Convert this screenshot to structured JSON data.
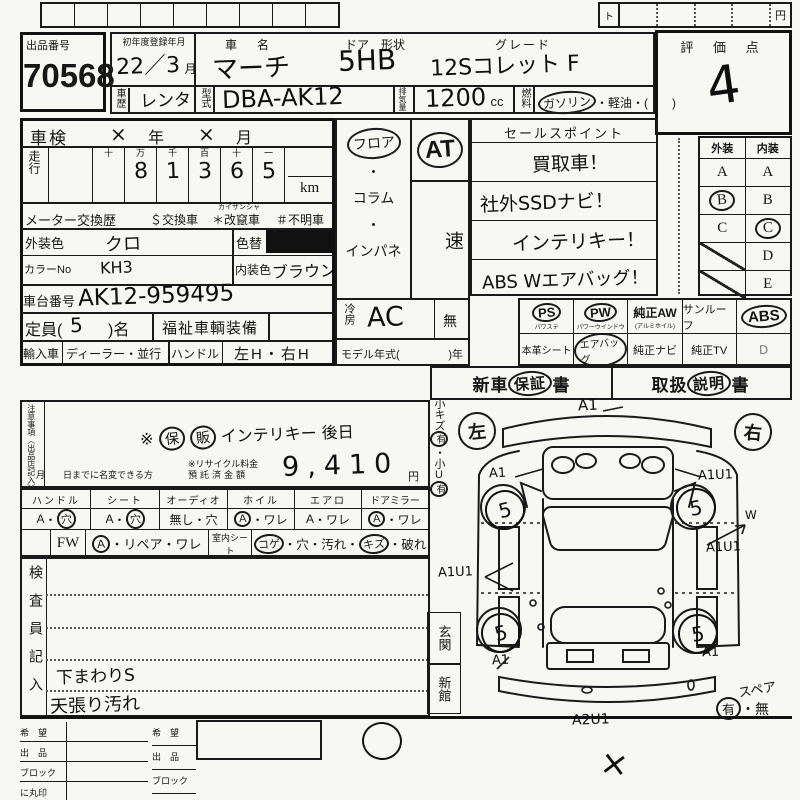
{
  "top": {
    "to": "ト",
    "yen": "円"
  },
  "header": {
    "auction_no_label": "出品番号",
    "auction_no": "70568",
    "first_reg_label": "初年度登録年月",
    "first_reg": "22／3",
    "first_reg_unit": "月",
    "history_label": "車歴",
    "history": "レンタ",
    "car_name_label": "車　名",
    "car_name": "マーチ",
    "door_label": "ドア　形状",
    "door": "5HB",
    "grade_label": "グレード",
    "grade": "12Sコレット F",
    "model_label": "型式",
    "model": "DBA-AK12",
    "disp_label": "排気量",
    "disp": "1200",
    "disp_unit": "cc",
    "fuel_label": "燃料",
    "fuel_gas": "ガソリン",
    "fuel_rest": "・軽油・(　　)",
    "score_label": "評 価 点",
    "score": "4"
  },
  "left": {
    "shaken_label": "車検",
    "x1": "×",
    "year": "年",
    "x2": "×",
    "month": "月",
    "mileage_label": "走行",
    "digit_headers": [
      "十",
      "万",
      "千",
      "百",
      "十",
      "一"
    ],
    "digits": [
      "",
      "8",
      "1",
      "3",
      "6",
      "5"
    ],
    "km": "km",
    "meter_label": "メーター交換歴",
    "meter1": "＄交換車",
    "meter2": "＊改竄車",
    "meter2_ruby": "カイザンシャ",
    "meter3": "＃不明車",
    "ext_color_label": "外装色",
    "ext_color": "クロ",
    "color_change_label": "色替",
    "color_no_label": "カラーNo",
    "color_no": "KH3",
    "int_color_label": "内装色",
    "int_color": "ブラウン",
    "chassis_label": "車台番号",
    "chassis": "AK12-959495",
    "cap_pre": "定員(",
    "cap": "5",
    "cap_post": ")名",
    "welfare": "福祉車輌装備",
    "import_label": "輸入車",
    "import_opts": "ディーラー・並行",
    "handle_label": "ハンドル",
    "handle_opts": "左H・右H"
  },
  "middle": {
    "floor": "フロア",
    "dot": "・",
    "column": "コラム",
    "panel": "インパネ",
    "at": "AT",
    "speed": "速",
    "ac_label": "冷房",
    "ac": "AC",
    "none": "無",
    "my_pre": "モデル年式(",
    "my_post": ")年"
  },
  "sales": {
    "title": "セールスポイント",
    "lines": [
      "買取車！",
      "社外SSDナビ！",
      "インテリキー！",
      "ABS Wエアバッグ！"
    ]
  },
  "grades": {
    "ext": "外装",
    "int": "内装",
    "rows": [
      {
        "e": "A",
        "i": "A"
      },
      {
        "e": "B",
        "i": "B"
      },
      {
        "e": "C",
        "i": "C"
      },
      {
        "e": "",
        "i": "D"
      },
      {
        "e": "",
        "i": "E"
      }
    ]
  },
  "equip": {
    "r1": [
      {
        "n": "PS",
        "s": "パワステ"
      },
      {
        "n": "PW",
        "s": "パワーウインドウ"
      },
      {
        "n": "純正AW",
        "s": "(アルミホイル)"
      },
      {
        "n": "サンルーフ",
        "s": ""
      },
      {
        "n": "ABS",
        "s": ""
      }
    ],
    "r2": [
      {
        "n": "本革シート"
      },
      {
        "n": "エアバッグ"
      },
      {
        "n": "純正ナビ"
      },
      {
        "n": "純正TV"
      },
      {
        "n": "D"
      }
    ]
  },
  "docs": {
    "w1": "新車",
    "w2": "保証",
    "w3": "書",
    "m1": "取扱",
    "m2": "説明",
    "m3": "書"
  },
  "notes": {
    "side": "注意事項〈出品店記入〉",
    "h1": "※",
    "h2": "保",
    "h3": "販",
    "h4": "インテリキー 後日",
    "recycle1": "※リサイクル料金",
    "recycle2": "預託済金額",
    "fee": "9,410",
    "fee_unit": "円",
    "rename": "月　　日までに名変できる方"
  },
  "cond": {
    "cols": [
      {
        "h": "ハンドル",
        "l": "A",
        "r": "穴"
      },
      {
        "h": "シート",
        "l": "A",
        "r": "穴"
      },
      {
        "h": "オーディオ",
        "l": "無し",
        "r": "穴"
      },
      {
        "h": "ホイル",
        "l": "A",
        "r": "ワレ"
      },
      {
        "h": "エアロ",
        "l": "A",
        "r": "ワレ"
      },
      {
        "h": "ドアミラー",
        "l": "A",
        "r": "ワレ"
      }
    ],
    "sep": "・",
    "fw": "FW",
    "fw_a": "A",
    "fw_rest": "・リペア・ワレ",
    "seat_label": "室内シート",
    "s1": "コゲ",
    "s2": "・穴・",
    "s3": "汚れ",
    "s4": "・",
    "s5": "キズ",
    "s6": "・破れ"
  },
  "inspector": {
    "side": "検査員記入",
    "note1": "下まわりS",
    "note2": "天張り汚れ"
  },
  "venue": {
    "a": "玄関",
    "b": "新館"
  },
  "diagram": {
    "strip1": "小キズ",
    "strip_yes1": "有",
    "strip_dot": "・",
    "strip2": "小U",
    "strip_yes2": "有",
    "left": "左",
    "right": "右",
    "front": "A1",
    "flw": "5",
    "fl": "A1",
    "frw": "5",
    "fr": "A1U1",
    "side_w": "W",
    "side_r": "A1U1",
    "side_l": "A1U1",
    "rlw": "5",
    "rl": "A1",
    "rrw": "5",
    "rr": "A1",
    "rear": "A2U1",
    "spare": "スペア",
    "spare_yes": "有",
    "spare_dot": "・",
    "spare_no": "無",
    "cross": "×"
  },
  "bottom": {
    "rows": [
      "希　望",
      "出　品",
      "ブロック",
      "に丸印"
    ]
  }
}
